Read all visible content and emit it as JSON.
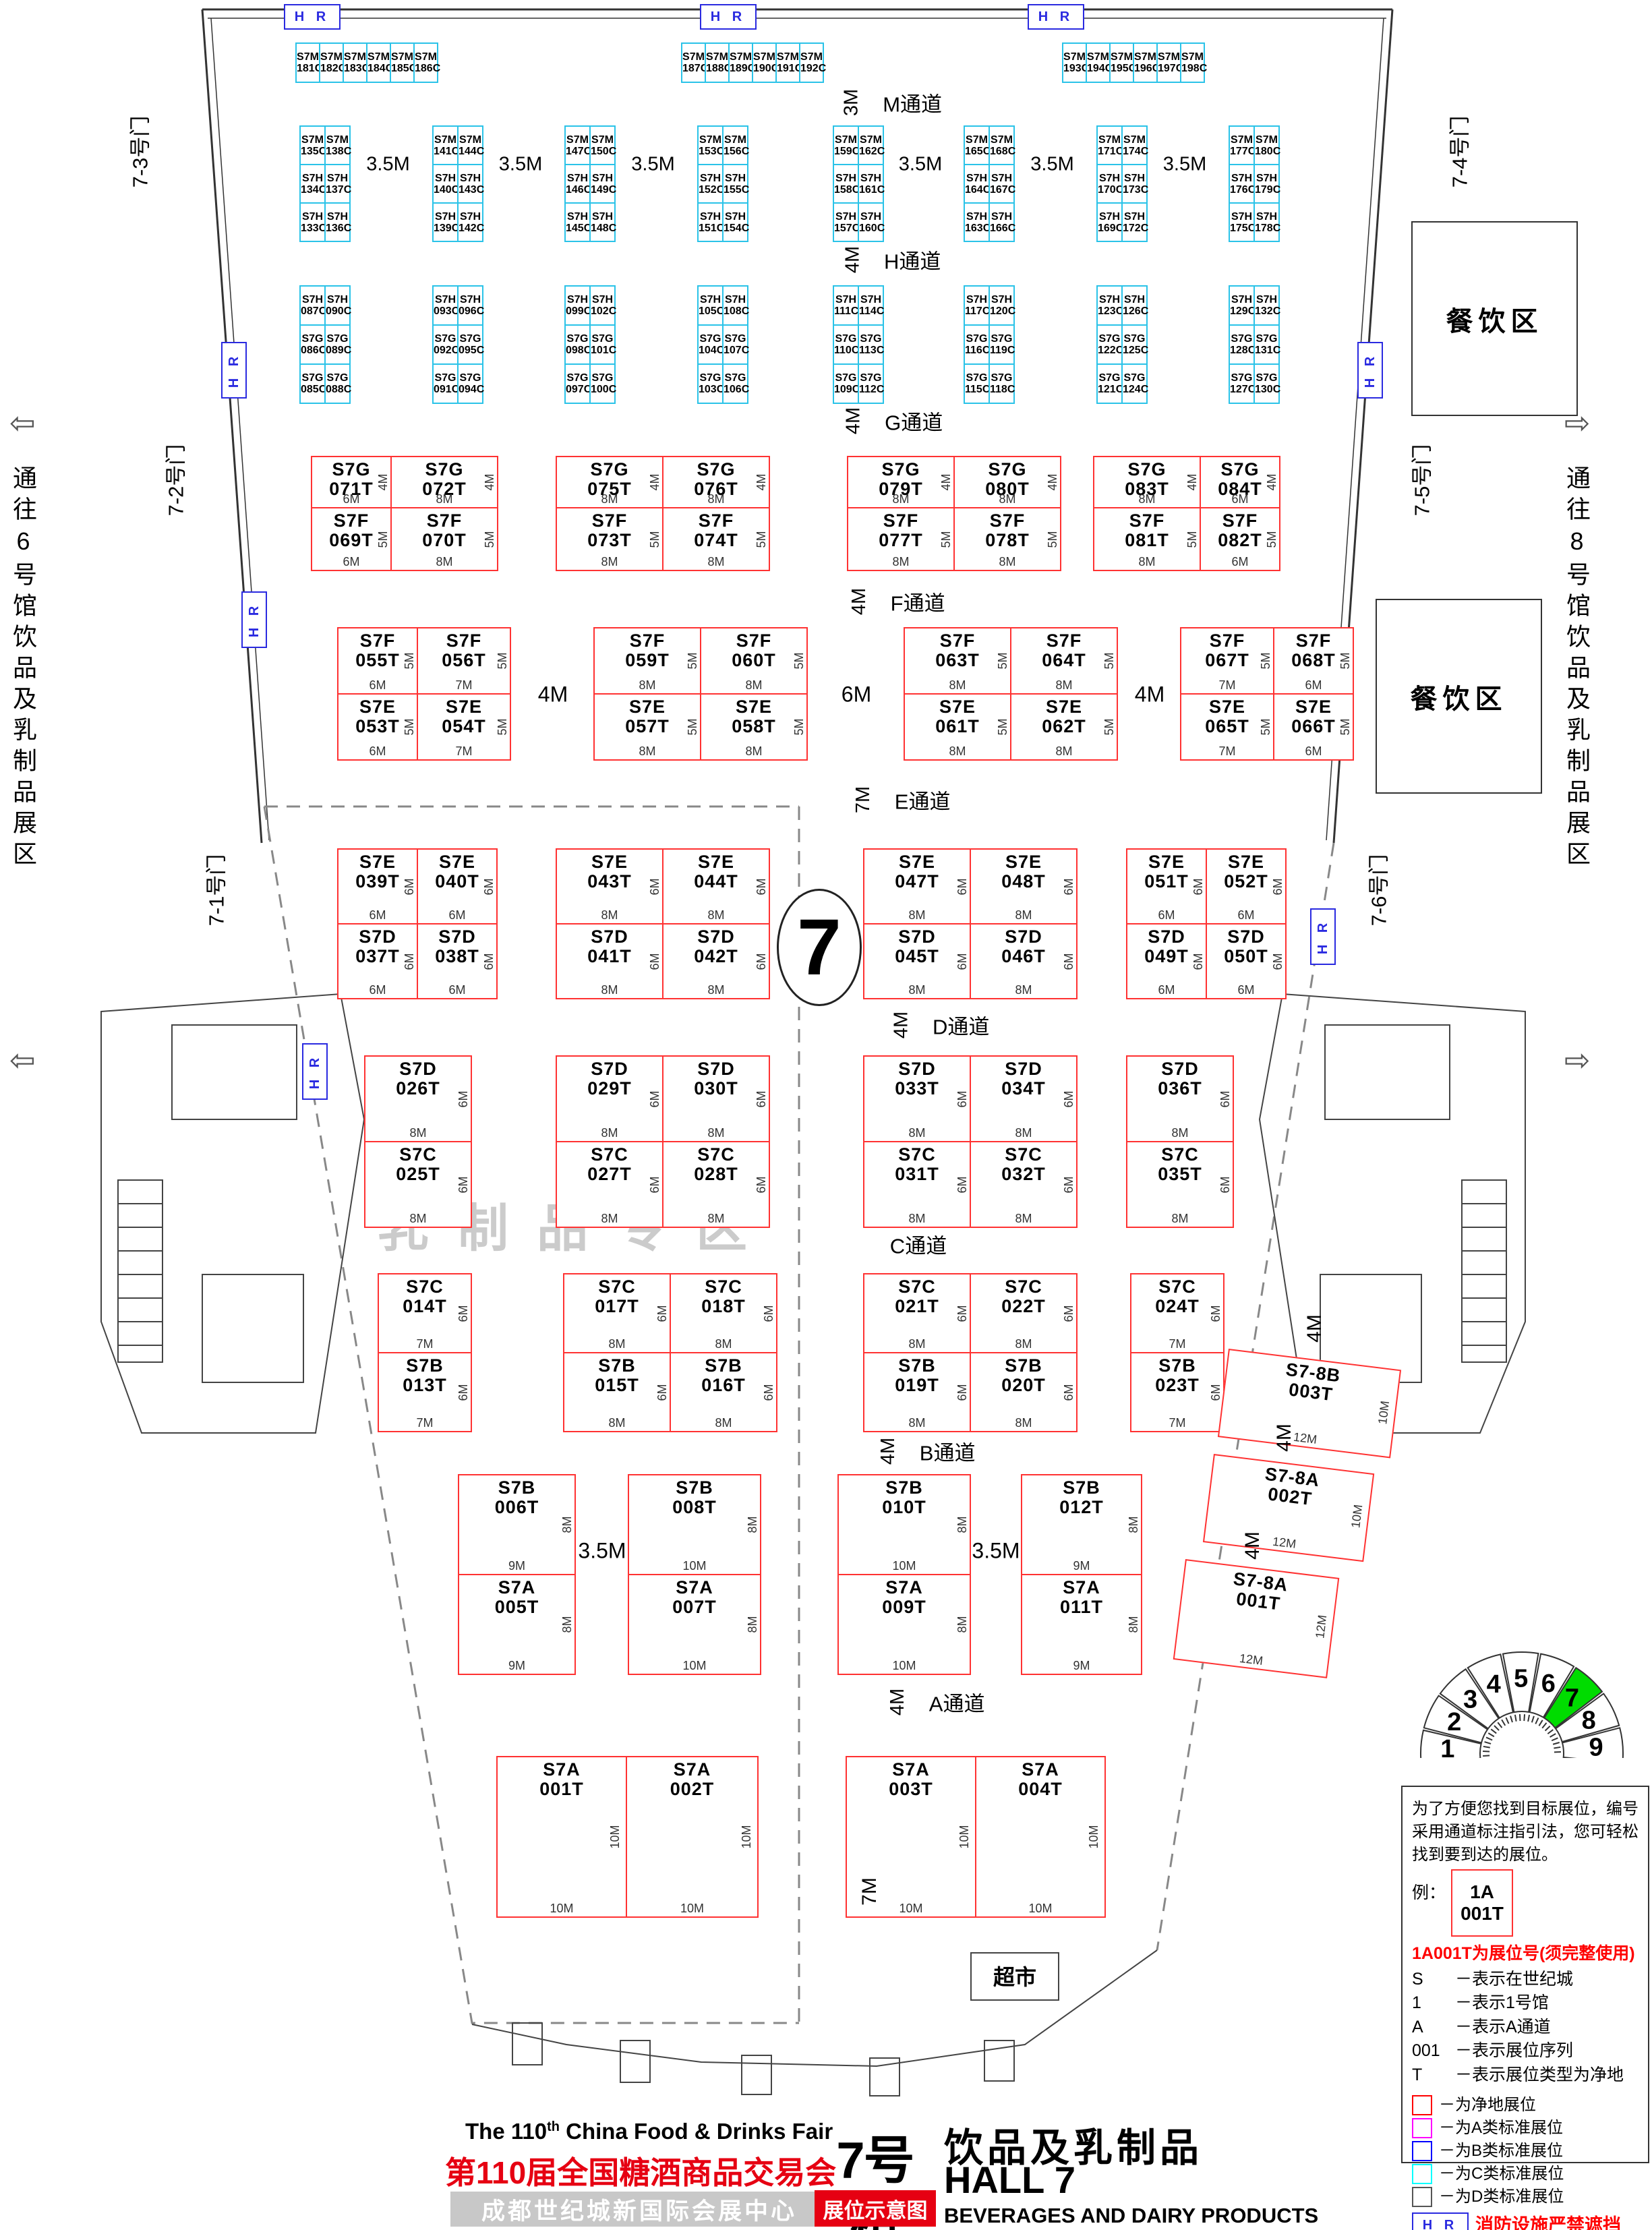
{
  "colors": {
    "red_booth": "#ff3232",
    "cyan_booth": "#2bc3e8",
    "hr_blue": "#2a2ae0",
    "title_red": "#e60012",
    "legend_clear": "#ff0000",
    "legend_a": "#ff00ff",
    "legend_b": "#0000ff",
    "legend_c": "#00ffff",
    "legend_d": "#555555",
    "hall_green": "#00dc00"
  },
  "hall_circle": "7",
  "watermark": "乳制品专区",
  "supermarket": "超市",
  "hr_label": "H R",
  "bottom_aisle_size": "7M",
  "corridors": {
    "left": "通往6号馆饮品及乳制品展区",
    "right": "通往8号馆饮品及乳制品展区",
    "left_arrow": "⇦",
    "right_arrow": "⇨"
  },
  "gates": [
    "7-3号门",
    "7-2号门",
    "7-1号门",
    "7-4号门",
    "7-5号门",
    "7-6号门"
  ],
  "dining_label": "餐饮区",
  "aisles": [
    {
      "key": "M",
      "size": "3M",
      "label": "M通道"
    },
    {
      "key": "H",
      "size": "4M",
      "label": "H通道"
    },
    {
      "key": "G",
      "size": "4M",
      "label": "G通道"
    },
    {
      "key": "F",
      "size": "4M",
      "label": "F通道"
    },
    {
      "key": "E",
      "size": "7M",
      "label": "E通道"
    },
    {
      "key": "D",
      "size": "4M",
      "label": "D通道"
    },
    {
      "key": "C",
      "size": "",
      "label": "C通道"
    },
    {
      "key": "B",
      "size": "4M",
      "label": "B通道"
    },
    {
      "key": "A",
      "size": "4M",
      "label": "A通道"
    }
  ],
  "bands": {
    "c_row_groups": [
      [
        "S7M 181C",
        "S7M 182C",
        "S7M 183C",
        "S7M 184C",
        "S7M 185C",
        "S7M 186C"
      ],
      [
        "S7M 187C",
        "S7M 188C",
        "S7M 189C",
        "S7M 190C",
        "S7M 191C",
        "S7M 192C"
      ],
      [
        "S7M 193C",
        "S7M 194C",
        "S7M 195C",
        "S7M 196C",
        "S7M 197C",
        "S7M 198C"
      ]
    ],
    "mh_gap": "3.5M",
    "mh_groups": [
      [
        [
          "S7M 135C",
          "S7M 138C"
        ],
        [
          "S7H 134C",
          "S7H 137C"
        ],
        [
          "S7H 133C",
          "S7H 136C"
        ]
      ],
      [
        [
          "S7M 141C",
          "S7M 144C"
        ],
        [
          "S7H 140C",
          "S7H 143C"
        ],
        [
          "S7H 139C",
          "S7H 142C"
        ]
      ],
      [
        [
          "S7M 147C",
          "S7M 150C"
        ],
        [
          "S7H 146C",
          "S7H 149C"
        ],
        [
          "S7H 145C",
          "S7H 148C"
        ]
      ],
      [
        [
          "S7M 153C",
          "S7M 156C"
        ],
        [
          "S7H 152C",
          "S7H 155C"
        ],
        [
          "S7H 151C",
          "S7H 154C"
        ]
      ],
      [
        [
          "S7M 159C",
          "S7M 162C"
        ],
        [
          "S7H 158C",
          "S7H 161C"
        ],
        [
          "S7H 157C",
          "S7H 160C"
        ]
      ],
      [
        [
          "S7M 165C",
          "S7M 168C"
        ],
        [
          "S7H 164C",
          "S7H 167C"
        ],
        [
          "S7H 163C",
          "S7H 166C"
        ]
      ],
      [
        [
          "S7M 171C",
          "S7M 174C"
        ],
        [
          "S7H 170C",
          "S7H 173C"
        ],
        [
          "S7H 169C",
          "S7H 172C"
        ]
      ],
      [
        [
          "S7M 177C",
          "S7M 180C"
        ],
        [
          "S7H 176C",
          "S7H 179C"
        ],
        [
          "S7H 175C",
          "S7H 178C"
        ]
      ]
    ],
    "hg_groups": [
      [
        [
          "S7H 087C",
          "S7H 090C"
        ],
        [
          "S7G 086C",
          "S7G 089C"
        ],
        [
          "S7G 085C",
          "S7G 088C"
        ]
      ],
      [
        [
          "S7H 093C",
          "S7H 096C"
        ],
        [
          "S7G 092C",
          "S7G 095C"
        ],
        [
          "S7G 091C",
          "S7G 094C"
        ]
      ],
      [
        [
          "S7H 099C",
          "S7H 102C"
        ],
        [
          "S7G 098C",
          "S7G 101C"
        ],
        [
          "S7G 097C",
          "S7G 100C"
        ]
      ],
      [
        [
          "S7H 105C",
          "S7H 108C"
        ],
        [
          "S7G 104C",
          "S7G 107C"
        ],
        [
          "S7G 103C",
          "S7G 106C"
        ]
      ],
      [
        [
          "S7H 111C",
          "S7H 114C"
        ],
        [
          "S7G 110C",
          "S7G 113C"
        ],
        [
          "S7G 109C",
          "S7G 112C"
        ]
      ],
      [
        [
          "S7H 117C",
          "S7H 120C"
        ],
        [
          "S7G 116C",
          "S7G 119C"
        ],
        [
          "S7G 115C",
          "S7G 118C"
        ]
      ],
      [
        [
          "S7H 123C",
          "S7H 126C"
        ],
        [
          "S7G 122C",
          "S7G 125C"
        ],
        [
          "S7G 121C",
          "S7G 124C"
        ]
      ],
      [
        [
          "S7H 129C",
          "S7H 132C"
        ],
        [
          "S7G 128C",
          "S7G 131C"
        ],
        [
          "S7G 127C",
          "S7G 130C"
        ]
      ]
    ],
    "gf": {
      "top_depth": "4M",
      "bottom_depth": "5M",
      "groups": [
        {
          "top": [
            "S7G 071T",
            "S7G 072T"
          ],
          "bottom": [
            "S7F 069T",
            "S7F 070T"
          ],
          "widths": [
            "6M",
            "8M"
          ]
        },
        {
          "top": [
            "S7G 075T",
            "S7G 076T"
          ],
          "bottom": [
            "S7F 073T",
            "S7F 074T"
          ],
          "widths": [
            "8M",
            "8M"
          ]
        },
        {
          "top": [
            "S7G 079T",
            "S7G 080T"
          ],
          "bottom": [
            "S7F 077T",
            "S7F 078T"
          ],
          "widths": [
            "8M",
            "8M"
          ]
        },
        {
          "top": [
            "S7G 083T",
            "S7G 084T"
          ],
          "bottom": [
            "S7F 081T",
            "S7F 082T"
          ],
          "widths": [
            "8M",
            "6M"
          ]
        }
      ]
    },
    "fe": {
      "top_depth": "5M",
      "bottom_depth": "5M",
      "gaps": [
        "4M",
        "6M",
        "4M"
      ],
      "groups": [
        {
          "top": [
            "S7F 055T",
            "S7F 056T"
          ],
          "bottom": [
            "S7E 053T",
            "S7E 054T"
          ],
          "widths": [
            "6M",
            "7M"
          ]
        },
        {
          "top": [
            "S7F 059T",
            "S7F 060T"
          ],
          "bottom": [
            "S7E 057T",
            "S7E 058T"
          ],
          "widths": [
            "8M",
            "8M"
          ]
        },
        {
          "top": [
            "S7F 063T",
            "S7F 064T"
          ],
          "bottom": [
            "S7E 061T",
            "S7E 062T"
          ],
          "widths": [
            "8M",
            "8M"
          ]
        },
        {
          "top": [
            "S7F 067T",
            "S7F 068T"
          ],
          "bottom": [
            "S7E 065T",
            "S7E 066T"
          ],
          "widths": [
            "7M",
            "6M"
          ]
        }
      ]
    },
    "ed": {
      "top_depth": "6M",
      "bottom_depth": "6M",
      "groups": [
        {
          "top": [
            "S7E 039T",
            "S7E 040T"
          ],
          "bottom": [
            "S7D 037T",
            "S7D 038T"
          ],
          "widths": [
            "6M",
            "6M"
          ]
        },
        {
          "top": [
            "S7E 043T",
            "S7E 044T"
          ],
          "bottom": [
            "S7D 041T",
            "S7D 042T"
          ],
          "widths": [
            "8M",
            "8M"
          ]
        },
        {
          "top": [
            "S7E 047T",
            "S7E 048T"
          ],
          "bottom": [
            "S7D 045T",
            "S7D 046T"
          ],
          "widths": [
            "8M",
            "8M"
          ]
        },
        {
          "top": [
            "S7E 051T",
            "S7E 052T"
          ],
          "bottom": [
            "S7D 049T",
            "S7D 050T"
          ],
          "widths": [
            "6M",
            "6M"
          ]
        }
      ]
    },
    "dc": {
      "top_depth": "6M",
      "bottom_depth": "6M",
      "groups": [
        {
          "top": [
            "S7D 026T"
          ],
          "bottom": [
            "S7C 025T"
          ],
          "widths": [
            "8M"
          ]
        },
        {
          "top": [
            "S7D 029T",
            "S7D 030T"
          ],
          "bottom": [
            "S7C 027T",
            "S7C 028T"
          ],
          "widths": [
            "8M",
            "8M"
          ]
        },
        {
          "top": [
            "S7D 033T",
            "S7D 034T"
          ],
          "bottom": [
            "S7C 031T",
            "S7C 032T"
          ],
          "widths": [
            "8M",
            "8M"
          ]
        },
        {
          "top": [
            "S7D 036T"
          ],
          "bottom": [
            "S7C 035T"
          ],
          "widths": [
            "8M"
          ]
        }
      ]
    },
    "cb": {
      "top_depth": "6M",
      "bottom_depth": "6M",
      "groups": [
        {
          "top": [
            "S7C 014T"
          ],
          "bottom": [
            "S7B 013T"
          ],
          "widths": [
            "7M"
          ]
        },
        {
          "top": [
            "S7C 017T",
            "S7C 018T"
          ],
          "bottom": [
            "S7B 015T",
            "S7B 016T"
          ],
          "widths": [
            "8M",
            "8M"
          ]
        },
        {
          "top": [
            "S7C 021T",
            "S7C 022T"
          ],
          "bottom": [
            "S7B 019T",
            "S7B 020T"
          ],
          "widths": [
            "8M",
            "8M"
          ]
        },
        {
          "top": [
            "S7C 024T"
          ],
          "bottom": [
            "S7B 023T"
          ],
          "widths": [
            "7M"
          ]
        }
      ]
    },
    "ba": {
      "depth": "8M",
      "gap_label": "3.5M",
      "top": [
        "S7B 006T",
        "S7B 008T",
        "S7B 010T",
        "S7B 012T"
      ],
      "bottom": [
        "S7A 005T",
        "S7A 007T",
        "S7A 009T",
        "S7A 011T"
      ],
      "widths": [
        "9M",
        "10M",
        "10M",
        "9M"
      ]
    },
    "a_row": {
      "depth": "10M",
      "width": "10M",
      "groups": [
        [
          "S7A 001T",
          "S7A 002T"
        ],
        [
          "S7A 003T",
          "S7A 004T"
        ]
      ]
    }
  },
  "side_booths": [
    {
      "code": "S7-8B 003T",
      "depth": "10M",
      "width": "12M",
      "gap": "4M"
    },
    {
      "code": "S7-8A 002T",
      "depth": "10M",
      "width": "12M",
      "gap": "4M"
    },
    {
      "code": "S7-8A 001T",
      "depth": "12M",
      "width": "12M",
      "gap": "4M"
    }
  ],
  "fan": {
    "halls": [
      "1",
      "2",
      "3",
      "4",
      "5",
      "6",
      "7",
      "8",
      "9"
    ],
    "highlight": "7"
  },
  "legend": {
    "intro": "为了方便您找到目标展位，编号采用通道标注指引法，您可轻松找到要到达的展位。",
    "example_label": "例：",
    "example_line1": "1A",
    "example_line2": "001T",
    "headline": "1A001T为展位号(须完整使用)",
    "items": [
      {
        "k": "S",
        "d": "－表示在世纪城"
      },
      {
        "k": "1",
        "d": "－表示1号馆"
      },
      {
        "k": "A",
        "d": "－表示A通道"
      },
      {
        "k": "001",
        "d": "－表示展位序列"
      },
      {
        "k": "T",
        "d": "－表示展位类型为净地"
      }
    ],
    "swatches": [
      {
        "color": "#ff0000",
        "label": "－为净地展位"
      },
      {
        "color": "#ff00ff",
        "label": "－为A类标准展位"
      },
      {
        "color": "#0000ff",
        "label": "－为B类标准展位"
      },
      {
        "color": "#00ffff",
        "label": "－为C类标准展位"
      },
      {
        "color": "#555555",
        "label": "－为D类标准展位"
      }
    ],
    "fire": "消防设施严禁遮挡"
  },
  "title": {
    "english_prefix": "The 110",
    "english_sup": "th",
    "english_suffix": " China Food & Drinks Fair",
    "chinese": "第110届全国糖酒商品交易会",
    "venue": "成都世纪城新国际会展中心",
    "hall_cn": "7号馆",
    "map_label": "展位示意图",
    "hall_category": "饮品及乳制品",
    "hall_en": "HALL 7",
    "hall_sub": "BEVERAGES AND DAIRY PRODUCTS"
  }
}
